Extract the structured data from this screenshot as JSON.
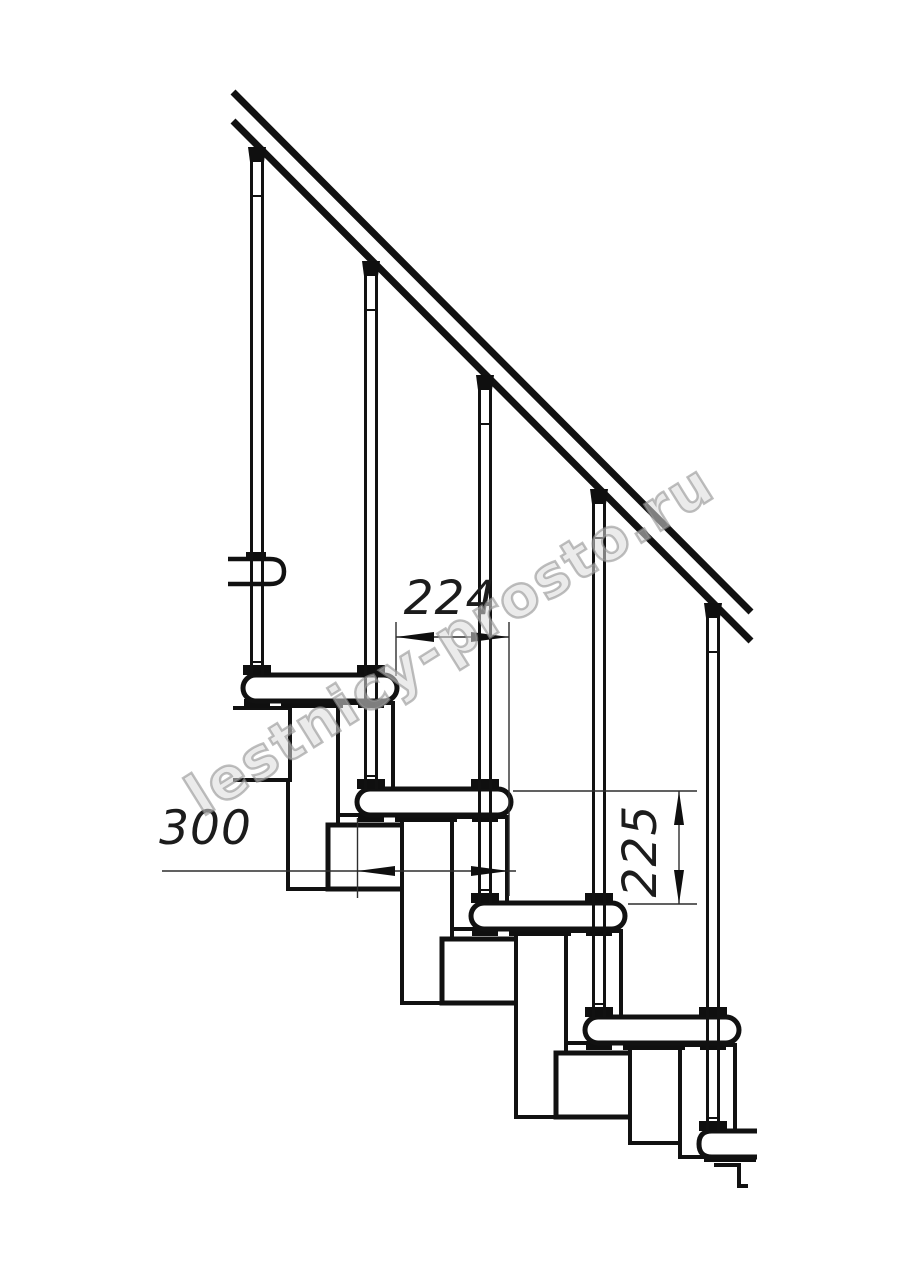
{
  "page": {
    "width": 914,
    "height": 1280,
    "background": "#ffffff"
  },
  "drawing": {
    "kind": "staircase-side-elevation",
    "watermark": "lestnicy-prosto.ru",
    "dimensions": {
      "run": "224",
      "depth": "300",
      "riser": "225"
    },
    "colors": {
      "line": "#111111",
      "dim": "#2d2d2d",
      "black_fill": "#0f0f0f",
      "fill": "#ffffff",
      "watermark": "#969696"
    },
    "counts": {
      "balusters": 5,
      "treads": 5
    }
  }
}
